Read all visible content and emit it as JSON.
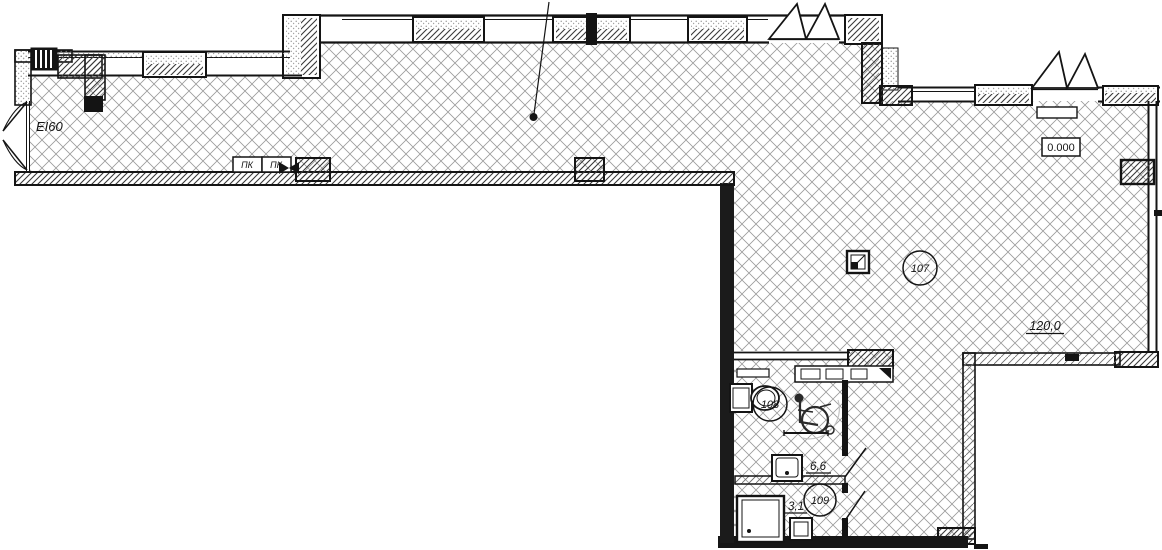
{
  "plan": {
    "name": "apartment-floor-plan",
    "colors": {
      "ink": "#141414",
      "floor_hatch": "#9b9b9b",
      "wall_hatch": "#3a3a3a",
      "insulation_stipple": "#909090"
    },
    "annotations": {
      "door_rating": "EI60",
      "elevation_mark": "0.000",
      "hydrant_1": "ПК",
      "hydrant_2": "ПК"
    },
    "rooms": [
      {
        "number": "107",
        "area": "120,0"
      },
      {
        "number": "108",
        "area": "6,6"
      },
      {
        "number": "109",
        "area": "3,1"
      }
    ]
  }
}
